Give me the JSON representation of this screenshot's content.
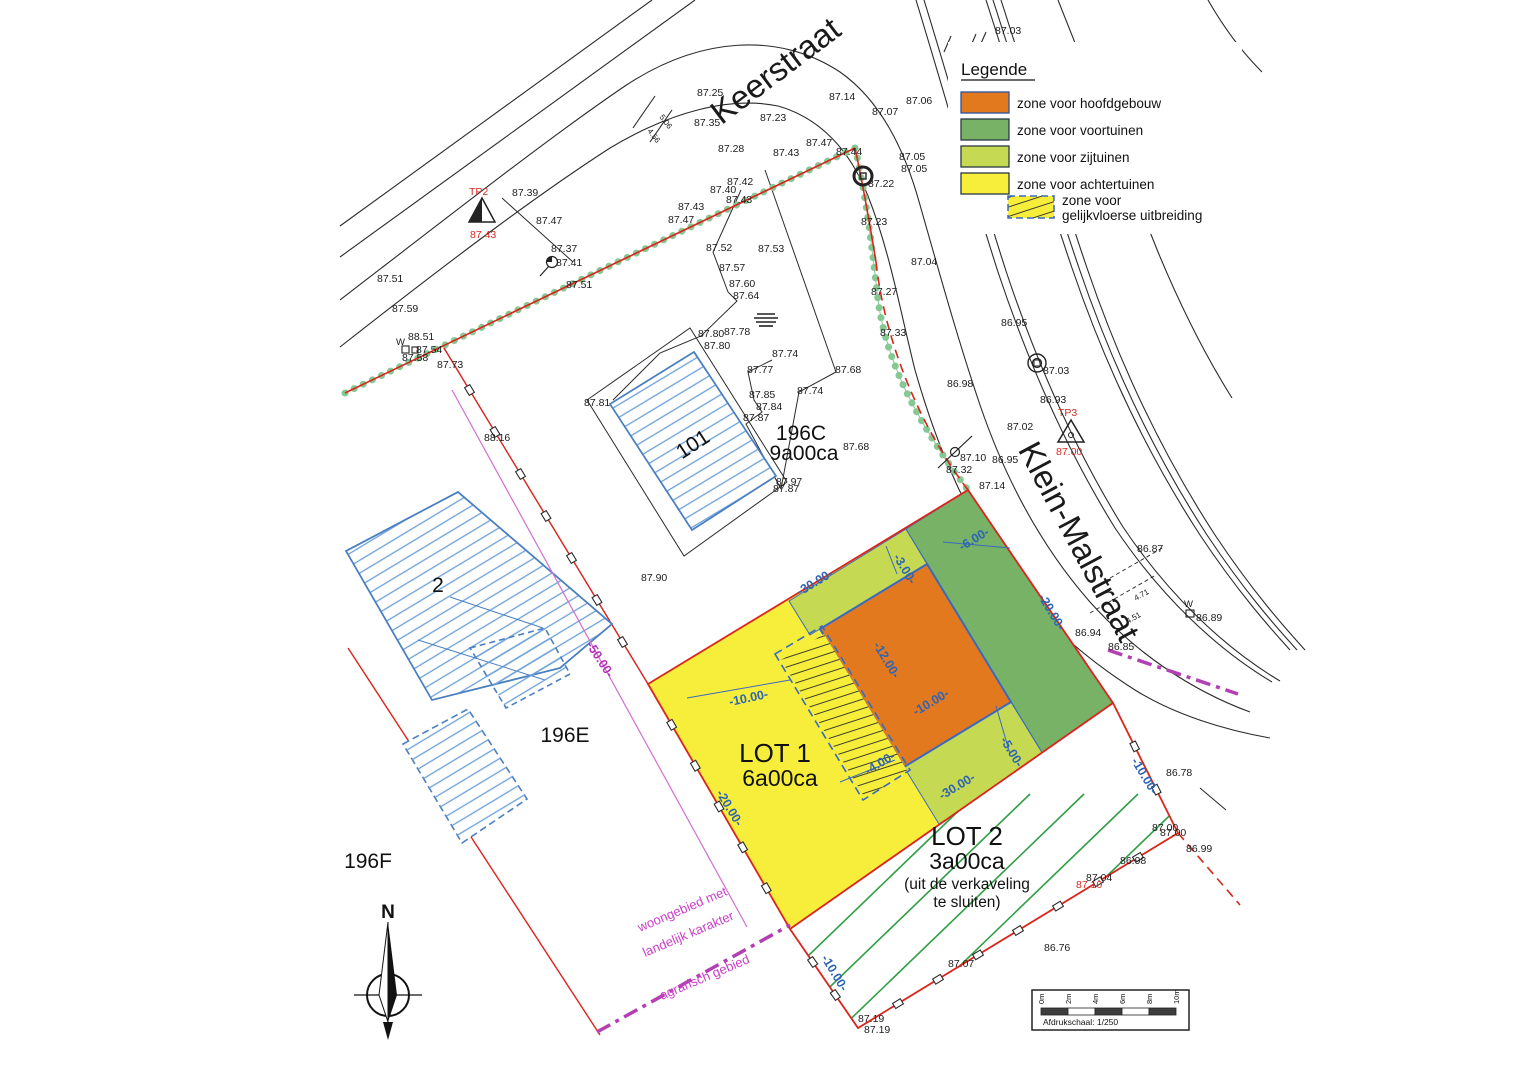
{
  "legend": {
    "title": "Legende",
    "items": [
      "zone voor hoofdgebouw",
      "zone voor voortuinen",
      "zone voor zijtuinen",
      "zone voor achtertuinen"
    ],
    "item5_line1": "zone voor",
    "item5_line2": "gelijkvloerse uitbreiding",
    "colors": {
      "hoofdgebouw": "#e2791f",
      "voortuinen": "#77b266",
      "zijtuinen": "#c5da52",
      "achtertuinen": "#f7ee3c"
    }
  },
  "streets": {
    "keerstraat": "Keerstraat",
    "klein_malstraat": "Klein-Malstraat"
  },
  "lot1": {
    "name": "LOT 1",
    "area": "6a00ca"
  },
  "lot2": {
    "name": "LOT 2",
    "area": "3a00ca",
    "note_line1": "(uit de verkaveling",
    "note_line2": "te sluiten)"
  },
  "parcels": {
    "house_large": "101",
    "house_small": "2",
    "p196c": "196C",
    "p196c_area": "9a00ca",
    "p196e": "196E",
    "p196f": "196F"
  },
  "zoning_labels": [
    "woongebied met",
    "landelijk karakter",
    "agrarisch gebied"
  ],
  "compass": {
    "north": "N"
  },
  "scalebar": {
    "ticks": [
      "0m",
      "2m",
      "4m",
      "6m",
      "8m",
      "10m"
    ],
    "caption": "Afdrukschaal: 1/250"
  },
  "dimensions": [
    {
      "t": "-30.00-",
      "x": 800,
      "y": 596,
      "r": -31
    },
    {
      "t": "-3.00-",
      "x": 893,
      "y": 557,
      "r": 59
    },
    {
      "t": "-6.00-",
      "x": 962,
      "y": 551,
      "r": -31
    },
    {
      "t": "-20.00-",
      "x": 1038,
      "y": 597,
      "r": 59
    },
    {
      "t": "-12.00-",
      "x": 873,
      "y": 645,
      "r": 59
    },
    {
      "t": "-10.00-",
      "x": 730,
      "y": 706,
      "r": -12
    },
    {
      "t": "-10.00-",
      "x": 916,
      "y": 716,
      "r": -31
    },
    {
      "t": "-5.00-",
      "x": 1000,
      "y": 740,
      "r": 59
    },
    {
      "t": "-4.00-",
      "x": 868,
      "y": 775,
      "r": -31
    },
    {
      "t": "-30.00-",
      "x": 942,
      "y": 800,
      "r": -31
    },
    {
      "t": "-10.00-",
      "x": 821,
      "y": 958,
      "r": 59
    },
    {
      "t": "-10.00-",
      "x": 1131,
      "y": 761,
      "r": 59
    },
    {
      "t": "-20.00-",
      "x": 716,
      "y": 793,
      "r": 59
    },
    {
      "t": "-50.00-",
      "x": 586,
      "y": 645,
      "r": 57,
      "c": "#b332b3"
    }
  ],
  "elevations": [
    {
      "t": "87.25",
      "x": 697,
      "y": 96
    },
    {
      "t": "87.35",
      "x": 694,
      "y": 126
    },
    {
      "t": "87.28",
      "x": 718,
      "y": 152
    },
    {
      "t": "87.23",
      "x": 760,
      "y": 121
    },
    {
      "t": "87.14",
      "x": 829,
      "y": 100
    },
    {
      "t": "87.07",
      "x": 872,
      "y": 115
    },
    {
      "t": "87.06",
      "x": 906,
      "y": 104
    },
    {
      "t": "87.05",
      "x": 899,
      "y": 160
    },
    {
      "t": "87.05",
      "x": 901,
      "y": 172
    },
    {
      "t": "87.1",
      "x": 1133,
      "y": 205
    },
    {
      "t": "87.04",
      "x": 911,
      "y": 265
    },
    {
      "t": "87.03",
      "x": 995,
      "y": 34
    },
    {
      "t": "87.47",
      "x": 806,
      "y": 146
    },
    {
      "t": "87.44",
      "x": 836,
      "y": 155
    },
    {
      "t": "87.22",
      "x": 868,
      "y": 187
    },
    {
      "t": "87.23",
      "x": 861,
      "y": 225
    },
    {
      "t": "87.43",
      "x": 773,
      "y": 156
    },
    {
      "t": "87.42",
      "x": 727,
      "y": 185
    },
    {
      "t": "87.40",
      "x": 710,
      "y": 193
    },
    {
      "t": "87.43",
      "x": 726,
      "y": 203
    },
    {
      "t": "87.43",
      "x": 678,
      "y": 210
    },
    {
      "t": "87.47",
      "x": 668,
      "y": 223
    },
    {
      "t": "87.39",
      "x": 512,
      "y": 196
    },
    {
      "t": "87.47",
      "x": 536,
      "y": 224
    },
    {
      "t": "87.37",
      "x": 551,
      "y": 252
    },
    {
      "t": "87.41",
      "x": 556,
      "y": 266
    },
    {
      "t": "87.51",
      "x": 566,
      "y": 288
    },
    {
      "t": "87.51",
      "x": 377,
      "y": 282
    },
    {
      "t": "87.59",
      "x": 392,
      "y": 312
    },
    {
      "t": "W",
      "x": 396,
      "y": 345,
      "s": 9.5
    },
    {
      "t": "88.51",
      "x": 408,
      "y": 340
    },
    {
      "t": "87.54",
      "x": 416,
      "y": 353
    },
    {
      "t": "87.58",
      "x": 402,
      "y": 361
    },
    {
      "t": "87.73",
      "x": 437,
      "y": 368
    },
    {
      "t": "88.16",
      "x": 484,
      "y": 441
    },
    {
      "t": "87.52",
      "x": 706,
      "y": 251
    },
    {
      "t": "87.53",
      "x": 758,
      "y": 252
    },
    {
      "t": "87.57",
      "x": 719,
      "y": 271
    },
    {
      "t": "87.60",
      "x": 729,
      "y": 287
    },
    {
      "t": "87.64",
      "x": 733,
      "y": 299
    },
    {
      "t": "87.27",
      "x": 871,
      "y": 295
    },
    {
      "t": "87.33",
      "x": 880,
      "y": 336
    },
    {
      "t": "87.80",
      "x": 698,
      "y": 337
    },
    {
      "t": "87.78",
      "x": 724,
      "y": 335
    },
    {
      "t": "87.80",
      "x": 704,
      "y": 349
    },
    {
      "t": "87.74",
      "x": 772,
      "y": 357
    },
    {
      "t": "87.77",
      "x": 747,
      "y": 373
    },
    {
      "t": "87.68",
      "x": 835,
      "y": 373
    },
    {
      "t": "87.74",
      "x": 797,
      "y": 394
    },
    {
      "t": "87.85",
      "x": 749,
      "y": 398
    },
    {
      "t": "87.84",
      "x": 756,
      "y": 410
    },
    {
      "t": "87.87",
      "x": 743,
      "y": 421
    },
    {
      "t": "87.81",
      "x": 584,
      "y": 406
    },
    {
      "t": "87.68",
      "x": 843,
      "y": 450
    },
    {
      "t": "87.97",
      "x": 776,
      "y": 485
    },
    {
      "t": "87.87",
      "x": 773,
      "y": 492
    },
    {
      "t": "87.90",
      "x": 641,
      "y": 581
    },
    {
      "t": "86.95",
      "x": 1001,
      "y": 326
    },
    {
      "t": "87.03",
      "x": 1043,
      "y": 374
    },
    {
      "t": "86.98",
      "x": 947,
      "y": 387
    },
    {
      "t": "86.93",
      "x": 1040,
      "y": 403
    },
    {
      "t": "87.02",
      "x": 1007,
      "y": 430
    },
    {
      "t": "87.10",
      "x": 960,
      "y": 461
    },
    {
      "t": "86.95",
      "x": 992,
      "y": 463
    },
    {
      "t": "87.32",
      "x": 946,
      "y": 473
    },
    {
      "t": "87.14",
      "x": 979,
      "y": 489
    },
    {
      "t": "86.87",
      "x": 1137,
      "y": 552
    },
    {
      "t": "W",
      "x": 1184,
      "y": 607,
      "s": 9.5
    },
    {
      "t": "86.89",
      "x": 1196,
      "y": 621
    },
    {
      "t": "86.94",
      "x": 1075,
      "y": 636
    },
    {
      "t": "86.85",
      "x": 1108,
      "y": 650
    },
    {
      "t": "86.78",
      "x": 1166,
      "y": 776
    },
    {
      "t": "87.00",
      "x": 1152,
      "y": 831
    },
    {
      "t": "87.00",
      "x": 1160,
      "y": 836
    },
    {
      "t": "86.99",
      "x": 1186,
      "y": 852
    },
    {
      "t": "86.98",
      "x": 1120,
      "y": 864
    },
    {
      "t": "87.04",
      "x": 1086,
      "y": 881
    },
    {
      "t": "87.10",
      "x": 1076,
      "y": 888,
      "c": "#d42a20"
    },
    {
      "t": "86.76",
      "x": 1044,
      "y": 951
    },
    {
      "t": "87.07",
      "x": 948,
      "y": 967
    },
    {
      "t": "87.19",
      "x": 858,
      "y": 1022
    },
    {
      "t": "87.19",
      "x": 864,
      "y": 1033
    },
    {
      "t": "TP2",
      "x": 469,
      "y": 195,
      "c": "#d42a20"
    },
    {
      "t": "87.43",
      "x": 470,
      "y": 238,
      "c": "#d42a20"
    },
    {
      "t": "TP3",
      "x": 1058,
      "y": 416,
      "c": "#d42a20"
    },
    {
      "t": "87.00",
      "x": 1056,
      "y": 455,
      "c": "#d42a20"
    },
    {
      "t": "5.06",
      "x": 659,
      "y": 117,
      "r": 53,
      "s": 8
    },
    {
      "t": "4.56",
      "x": 647,
      "y": 131,
      "r": 53,
      "s": 8
    },
    {
      "t": "4.71",
      "x": 1136,
      "y": 601,
      "r": -30,
      "s": 8
    },
    {
      "t": "4.51",
      "x": 1128,
      "y": 624,
      "r": -30,
      "s": 8
    }
  ]
}
